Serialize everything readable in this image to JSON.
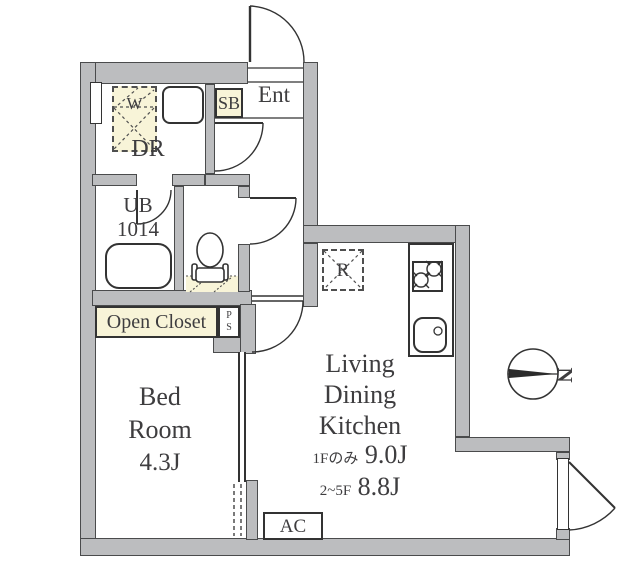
{
  "plan": {
    "rooms": {
      "entrance": {
        "label": "Ent"
      },
      "shoe_box": {
        "label": "SB"
      },
      "dressing_room": {
        "label": "DR"
      },
      "washing_machine_space": {
        "label": "W"
      },
      "unit_bath": {
        "label": "UB",
        "size_code": "1014"
      },
      "pipe_space": {
        "letters": [
          "P",
          "S"
        ]
      },
      "open_closet": {
        "label": "Open Closet"
      },
      "bedroom": {
        "name_lines": [
          "Bed",
          "Room"
        ],
        "size": "4.3J"
      },
      "ldk": {
        "name_lines": [
          "Living",
          "Dining",
          "Kitchen"
        ],
        "sizes": [
          {
            "floors": "1Fのみ",
            "area": "9.0J"
          },
          {
            "floors": "2~5F",
            "area": "8.8J"
          }
        ]
      },
      "refrigerator_space": {
        "label": "R"
      },
      "air_conditioner": {
        "label": "AC"
      }
    },
    "compass": {
      "label": "N"
    },
    "colors": {
      "wall": "#bcbdbf",
      "wall_edge": "#4a4b4c",
      "accent_cream": "#f8f4d8",
      "line": "#333333",
      "text": "#3e3d3f"
    }
  }
}
